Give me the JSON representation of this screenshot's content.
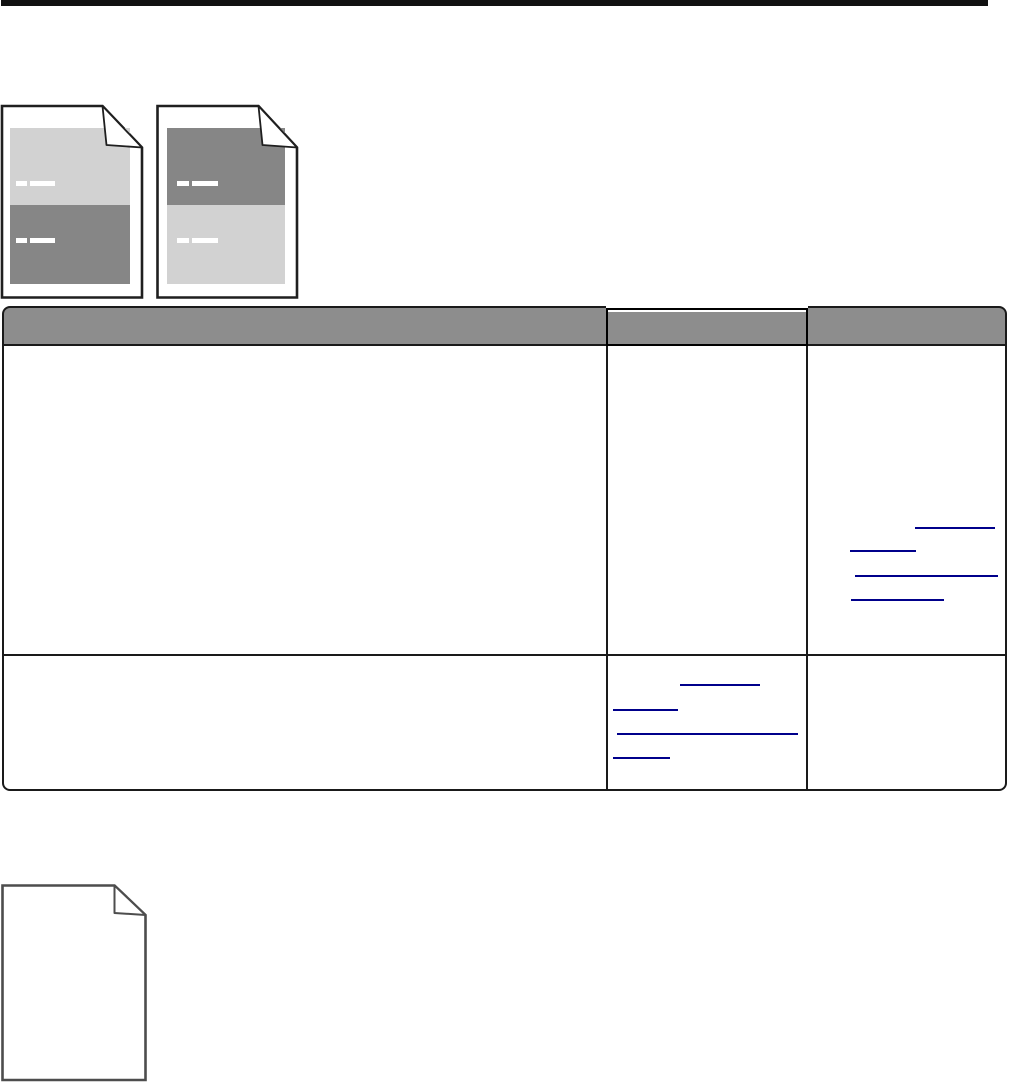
{
  "colors": {
    "background": "#ffffff",
    "top_rule": "#111111",
    "sample_border": "#1f1f1f",
    "blank_page_border": "#4d4d4d",
    "band_light": "#d2d2d2",
    "band_dark": "#868686",
    "header_fill": "#8d8d8d",
    "table_border": "#1a1a1a",
    "link_blue": "#00008b",
    "dash_white": "#ffffff"
  },
  "figures": {
    "sample_page_left": {
      "alt": "print sample: light gray upper half, dark gray lower half, folded top-right corner",
      "bands": [
        "light",
        "dark"
      ]
    },
    "sample_page_right": {
      "alt": "print sample: dark gray upper half, light gray lower half, folded top-right corner",
      "bands": [
        "dark",
        "light"
      ]
    },
    "blank_page": {
      "alt": "blank white page with folded top-right corner"
    }
  },
  "white_dashes": [
    {
      "x": 16,
      "y": 181,
      "w": 11,
      "h": 5
    },
    {
      "x": 30,
      "y": 181,
      "w": 25,
      "h": 5
    },
    {
      "x": 16,
      "y": 238,
      "w": 11,
      "h": 5
    },
    {
      "x": 30,
      "y": 238,
      "w": 25,
      "h": 5
    },
    {
      "x": 177,
      "y": 181,
      "w": 12,
      "h": 5
    },
    {
      "x": 192,
      "y": 181,
      "w": 26,
      "h": 5
    },
    {
      "x": 177,
      "y": 238,
      "w": 12,
      "h": 5
    },
    {
      "x": 192,
      "y": 238,
      "w": 26,
      "h": 5
    }
  ],
  "table": {
    "header": [
      "",
      "",
      ""
    ],
    "cells_text": [
      [
        "",
        "",
        ""
      ],
      [
        "",
        "",
        ""
      ]
    ]
  },
  "link_underlines": [
    {
      "x": 915,
      "y": 527,
      "w": 80
    },
    {
      "x": 850,
      "y": 550,
      "w": 66
    },
    {
      "x": 855,
      "y": 575,
      "w": 143
    },
    {
      "x": 851,
      "y": 599,
      "w": 93
    },
    {
      "x": 680,
      "y": 684,
      "w": 80
    },
    {
      "x": 613,
      "y": 709,
      "w": 65
    },
    {
      "x": 617,
      "y": 733,
      "w": 181
    },
    {
      "x": 613,
      "y": 757,
      "w": 57
    }
  ]
}
